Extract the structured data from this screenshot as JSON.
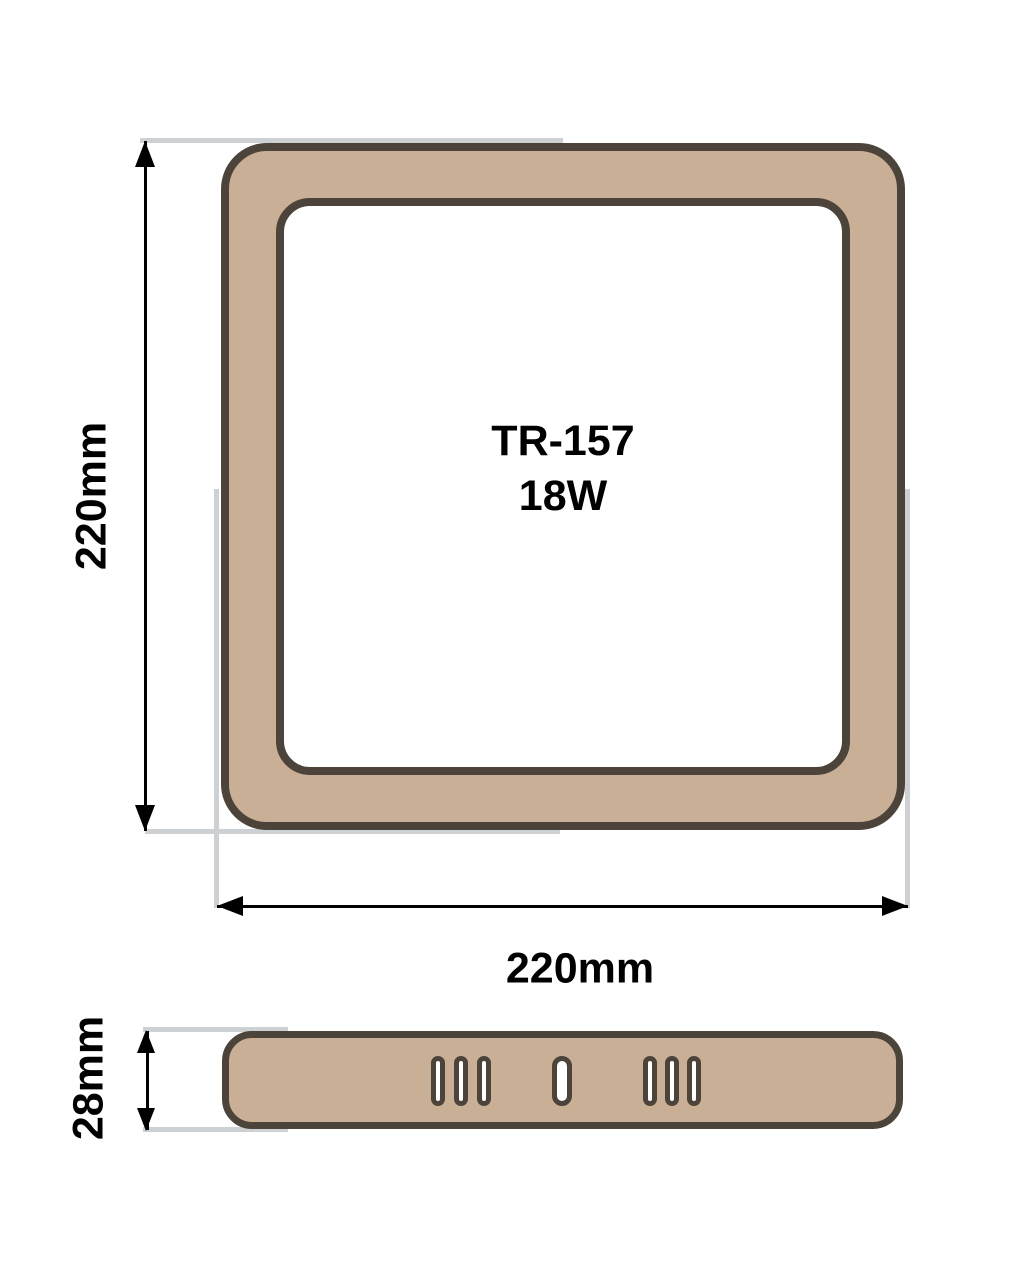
{
  "product": {
    "model": "TR-157",
    "wattage": "18W"
  },
  "dimensions": {
    "height": "220mm",
    "width": "220mm",
    "thickness": "28mm"
  },
  "side_view": {
    "vent_groups": [
      {
        "count": 3,
        "slot_width": 14
      },
      {
        "count": 1,
        "slot_width": 20
      },
      {
        "count": 3,
        "slot_width": 14
      }
    ]
  },
  "colors": {
    "panel_fill": "#c9af96",
    "panel_outline": "#4c433a",
    "extension_line": "#cdd1d4",
    "dimension_line": "#000000",
    "label_text": "#000000",
    "background": "#ffffff"
  }
}
